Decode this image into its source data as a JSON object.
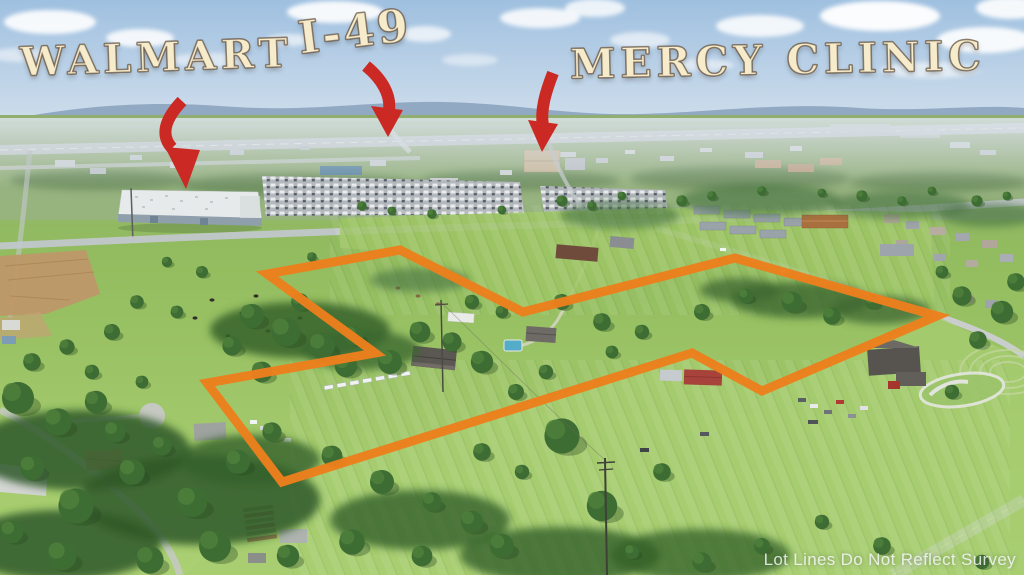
{
  "annotations": {
    "walmart": {
      "label": "WALMART"
    },
    "i49": {
      "label": "I-49"
    },
    "mercy_clinic": {
      "label": "MERCY CLINIC"
    }
  },
  "watermark": {
    "text": "Lot Lines Do Not Reflect Survey"
  },
  "boundary": {
    "points": "267,274 400,250 523,312 735,258 937,316 762,391 692,353 282,482 207,383 375,353",
    "color": "#EC7F1D",
    "stroke_width": 9
  },
  "arrows": {
    "color": "#CB2A24",
    "walmart": {
      "shaft": "M182,101 C165,119 160,135 172,148",
      "head": "M165,147 L200,150 L186,189 Z"
    },
    "i49": {
      "shaft": "M366,66 C382,79 391,95 389,110",
      "head": "M371,106 L403,110 L388,137 Z"
    },
    "mercy": {
      "shaft": "M553,73 C546,91 540,110 543,126",
      "head": "M528,120 L558,124 L542,152 Z"
    }
  },
  "palette": {
    "label_fill": "#F6EBCB",
    "label_outline": "#6B5847"
  }
}
